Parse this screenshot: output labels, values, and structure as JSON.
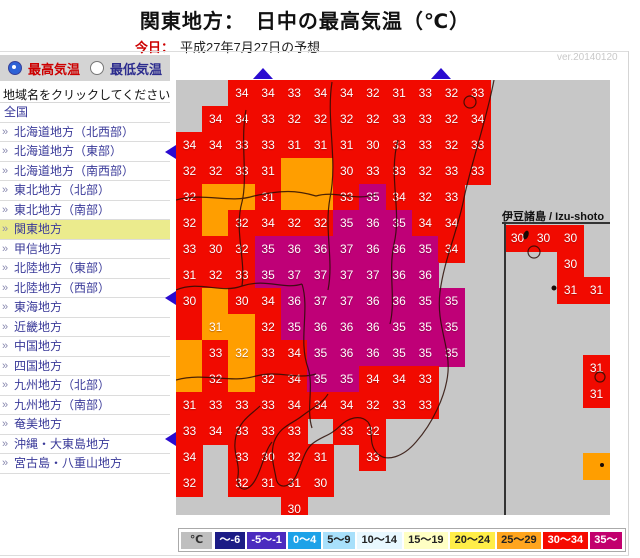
{
  "header": {
    "title": "関東地方：　日中の最高気温（℃）",
    "today_label": "今日：",
    "date_text": "平成27年7月27日の予想",
    "version": "ver.20140120"
  },
  "sidebar": {
    "radio_max": "最高気温",
    "radio_min": "最低気温",
    "instruction": "地域名をクリックしてください",
    "items": [
      {
        "label": "全国",
        "arrow": false,
        "active": false
      },
      {
        "label": "北海道地方（北西部）",
        "arrow": true,
        "active": false
      },
      {
        "label": "北海道地方（東部）",
        "arrow": true,
        "active": false
      },
      {
        "label": "北海道地方（南西部）",
        "arrow": true,
        "active": false
      },
      {
        "label": "東北地方（北部）",
        "arrow": true,
        "active": false
      },
      {
        "label": "東北地方（南部）",
        "arrow": true,
        "active": false
      },
      {
        "label": "関東地方",
        "arrow": true,
        "active": true
      },
      {
        "label": "甲信地方",
        "arrow": true,
        "active": false
      },
      {
        "label": "北陸地方（東部）",
        "arrow": true,
        "active": false
      },
      {
        "label": "北陸地方（西部）",
        "arrow": true,
        "active": false
      },
      {
        "label": "東海地方",
        "arrow": true,
        "active": false
      },
      {
        "label": "近畿地方",
        "arrow": true,
        "active": false
      },
      {
        "label": "中国地方",
        "arrow": true,
        "active": false
      },
      {
        "label": "四国地方",
        "arrow": true,
        "active": false
      },
      {
        "label": "九州地方（北部）",
        "arrow": true,
        "active": false
      },
      {
        "label": "九州地方（南部）",
        "arrow": true,
        "active": false
      },
      {
        "label": "奄美地方",
        "arrow": true,
        "active": false
      },
      {
        "label": "沖縄・大東島地方",
        "arrow": true,
        "active": false
      },
      {
        "label": "宮古島・八重山地方",
        "arrow": true,
        "active": false
      }
    ]
  },
  "map": {
    "izu_label": "伊豆諸島 / Izu-shoto",
    "rows": [
      {
        "r": 0,
        "cells": [
          [
            2,
            "34",
            "R"
          ],
          [
            3,
            "34",
            "R"
          ],
          [
            4,
            "33",
            "R"
          ],
          [
            5,
            "34",
            "R"
          ],
          [
            6,
            "34",
            "R"
          ],
          [
            7,
            "32",
            "R"
          ],
          [
            8,
            "31",
            "R"
          ],
          [
            9,
            "33",
            "R"
          ],
          [
            10,
            "32",
            "R"
          ],
          [
            11,
            "33",
            "R"
          ]
        ]
      },
      {
        "r": 1,
        "cells": [
          [
            1,
            "34",
            "R"
          ],
          [
            2,
            "34",
            "R"
          ],
          [
            3,
            "33",
            "R"
          ],
          [
            4,
            "32",
            "R"
          ],
          [
            5,
            "32",
            "R"
          ],
          [
            6,
            "32",
            "R"
          ],
          [
            7,
            "32",
            "R"
          ],
          [
            8,
            "33",
            "R"
          ],
          [
            9,
            "33",
            "R"
          ],
          [
            10,
            "32",
            "R"
          ],
          [
            11,
            "34",
            "R"
          ]
        ]
      },
      {
        "r": 2,
        "cells": [
          [
            0,
            "34",
            "R"
          ],
          [
            1,
            "34",
            "R"
          ],
          [
            2,
            "33",
            "R"
          ],
          [
            3,
            "33",
            "R"
          ],
          [
            4,
            "31",
            "R"
          ],
          [
            5,
            "31",
            "R"
          ],
          [
            6,
            "31",
            "R"
          ],
          [
            7,
            "30",
            "R"
          ],
          [
            8,
            "33",
            "R"
          ],
          [
            9,
            "33",
            "R"
          ],
          [
            10,
            "32",
            "R"
          ],
          [
            11,
            "33",
            "R"
          ]
        ]
      },
      {
        "r": 3,
        "cells": [
          [
            0,
            "32",
            "R"
          ],
          [
            1,
            "32",
            "R"
          ],
          [
            2,
            "33",
            "R"
          ],
          [
            3,
            "31",
            "R"
          ],
          [
            4,
            "",
            "O"
          ],
          [
            5,
            "",
            "O"
          ],
          [
            6,
            "30",
            "R"
          ],
          [
            7,
            "33",
            "R"
          ],
          [
            8,
            "33",
            "R"
          ],
          [
            9,
            "32",
            "R"
          ],
          [
            10,
            "33",
            "R"
          ],
          [
            11,
            "33",
            "R"
          ]
        ]
      },
      {
        "r": 4,
        "cells": [
          [
            0,
            "32",
            "R"
          ],
          [
            1,
            "",
            "O"
          ],
          [
            2,
            "",
            "O"
          ],
          [
            3,
            "31",
            "R"
          ],
          [
            4,
            "",
            "O"
          ],
          [
            5,
            "",
            "O"
          ],
          [
            6,
            "33",
            "R"
          ],
          [
            7,
            "35",
            "P"
          ],
          [
            8,
            "34",
            "R"
          ],
          [
            9,
            "32",
            "R"
          ],
          [
            10,
            "33",
            "R"
          ]
        ]
      },
      {
        "r": 5,
        "cells": [
          [
            0,
            "32",
            "R"
          ],
          [
            1,
            "",
            "O"
          ],
          [
            2,
            "32",
            "R"
          ],
          [
            3,
            "34",
            "R"
          ],
          [
            4,
            "32",
            "R"
          ],
          [
            5,
            "32",
            "R"
          ],
          [
            6,
            "35",
            "P"
          ],
          [
            7,
            "36",
            "P"
          ],
          [
            8,
            "35",
            "P"
          ],
          [
            9,
            "34",
            "R"
          ],
          [
            10,
            "34",
            "R"
          ]
        ]
      },
      {
        "r": 6,
        "cells": [
          [
            0,
            "33",
            "R"
          ],
          [
            1,
            "30",
            "R"
          ],
          [
            2,
            "32",
            "R"
          ],
          [
            3,
            "35",
            "P"
          ],
          [
            4,
            "36",
            "P"
          ],
          [
            5,
            "36",
            "P"
          ],
          [
            6,
            "37",
            "P"
          ],
          [
            7,
            "36",
            "P"
          ],
          [
            8,
            "36",
            "P"
          ],
          [
            9,
            "35",
            "P"
          ],
          [
            10,
            "34",
            "R"
          ]
        ]
      },
      {
        "r": 7,
        "cells": [
          [
            0,
            "31",
            "R"
          ],
          [
            1,
            "32",
            "R"
          ],
          [
            2,
            "33",
            "R"
          ],
          [
            3,
            "35",
            "P"
          ],
          [
            4,
            "37",
            "P"
          ],
          [
            5,
            "37",
            "P"
          ],
          [
            6,
            "37",
            "P"
          ],
          [
            7,
            "37",
            "P"
          ],
          [
            8,
            "36",
            "P"
          ],
          [
            9,
            "36",
            "P"
          ]
        ]
      },
      {
        "r": 8,
        "cells": [
          [
            0,
            "30",
            "R"
          ],
          [
            1,
            "",
            "O"
          ],
          [
            2,
            "30",
            "R"
          ],
          [
            3,
            "34",
            "R"
          ],
          [
            4,
            "36",
            "P"
          ],
          [
            5,
            "37",
            "P"
          ],
          [
            6,
            "37",
            "P"
          ],
          [
            7,
            "36",
            "P"
          ],
          [
            8,
            "36",
            "P"
          ],
          [
            9,
            "35",
            "P"
          ],
          [
            10,
            "35",
            "P"
          ]
        ]
      },
      {
        "r": 9,
        "cells": [
          [
            0,
            "",
            "R"
          ],
          [
            1,
            "31",
            "O"
          ],
          [
            2,
            "",
            "O"
          ],
          [
            3,
            "32",
            "R"
          ],
          [
            4,
            "35",
            "P"
          ],
          [
            5,
            "36",
            "P"
          ],
          [
            6,
            "36",
            "P"
          ],
          [
            7,
            "36",
            "P"
          ],
          [
            8,
            "35",
            "P"
          ],
          [
            9,
            "35",
            "P"
          ],
          [
            10,
            "35",
            "P"
          ]
        ]
      },
      {
        "r": 10,
        "cells": [
          [
            0,
            "",
            "O"
          ],
          [
            1,
            "33",
            "R"
          ],
          [
            2,
            "32",
            "O"
          ],
          [
            3,
            "33",
            "R"
          ],
          [
            4,
            "34",
            "R"
          ],
          [
            5,
            "35",
            "P"
          ],
          [
            6,
            "36",
            "P"
          ],
          [
            7,
            "36",
            "P"
          ],
          [
            8,
            "35",
            "P"
          ],
          [
            9,
            "35",
            "P"
          ],
          [
            10,
            "35",
            "P"
          ]
        ]
      },
      {
        "r": 11,
        "cells": [
          [
            0,
            "",
            "O"
          ],
          [
            1,
            "32",
            "R"
          ],
          [
            2,
            "",
            "O"
          ],
          [
            3,
            "32",
            "R"
          ],
          [
            4,
            "34",
            "R"
          ],
          [
            5,
            "35",
            "P"
          ],
          [
            6,
            "35",
            "P"
          ],
          [
            7,
            "34",
            "R"
          ],
          [
            8,
            "34",
            "R"
          ],
          [
            9,
            "33",
            "R"
          ]
        ]
      },
      {
        "r": 12,
        "cells": [
          [
            0,
            "31",
            "R"
          ],
          [
            1,
            "33",
            "R"
          ],
          [
            2,
            "33",
            "R"
          ],
          [
            3,
            "33",
            "R"
          ],
          [
            4,
            "34",
            "R"
          ],
          [
            5,
            "34",
            "R"
          ],
          [
            6,
            "34",
            "R"
          ],
          [
            7,
            "32",
            "R"
          ],
          [
            8,
            "33",
            "R"
          ],
          [
            9,
            "33",
            "R"
          ]
        ]
      },
      {
        "r": 13,
        "cells": [
          [
            0,
            "33",
            "R"
          ],
          [
            1,
            "34",
            "R"
          ],
          [
            2,
            "33",
            "R"
          ],
          [
            3,
            "33",
            "R"
          ],
          [
            4,
            "33",
            "R"
          ],
          [
            6,
            "33",
            "R"
          ],
          [
            7,
            "32",
            "R"
          ]
        ]
      },
      {
        "r": 14,
        "cells": [
          [
            0,
            "34",
            "R"
          ],
          [
            2,
            "33",
            "R"
          ],
          [
            3,
            "30",
            "R"
          ],
          [
            4,
            "32",
            "R"
          ],
          [
            5,
            "31",
            "R"
          ],
          [
            7,
            "33",
            "R"
          ]
        ]
      },
      {
        "r": 15,
        "cells": [
          [
            0,
            "32",
            "R"
          ],
          [
            2,
            "32",
            "R"
          ],
          [
            3,
            "31",
            "R"
          ],
          [
            4,
            "31",
            "R"
          ],
          [
            5,
            "30",
            "R"
          ]
        ]
      },
      {
        "r": 16,
        "cells": [
          [
            4,
            "30",
            "R"
          ]
        ]
      }
    ],
    "izu_cells": [
      {
        "x": 328,
        "y": 145,
        "v": "30",
        "t": "R"
      },
      {
        "x": 354,
        "y": 145,
        "v": "30",
        "t": "R"
      },
      {
        "x": 381,
        "y": 145,
        "v": "30",
        "t": "R"
      },
      {
        "x": 381,
        "y": 171,
        "v": "30",
        "t": "R"
      },
      {
        "x": 381,
        "y": 197,
        "v": "31",
        "t": "R"
      },
      {
        "x": 407,
        "y": 197,
        "v": "31",
        "t": "R"
      },
      {
        "x": 407,
        "y": 275,
        "v": "31",
        "t": "R"
      },
      {
        "x": 407,
        "y": 301,
        "v": "31",
        "t": "R"
      },
      {
        "x": 407,
        "y": 373,
        "v": "",
        "t": "O"
      }
    ]
  },
  "legend": {
    "unit": "℃",
    "ranges": [
      {
        "label": "～-6",
        "bg": "#1c1c86",
        "fg": "#ffffff"
      },
      {
        "label": "-5～-1",
        "bg": "#4b2bbf",
        "fg": "#ffffff"
      },
      {
        "label": "0～4",
        "bg": "#1da2e8",
        "fg": "#ffffff"
      },
      {
        "label": "5～9",
        "bg": "#a8e0fb",
        "fg": "#222222"
      },
      {
        "label": "10～14",
        "bg": "#e8f8ff",
        "fg": "#222222"
      },
      {
        "label": "15～19",
        "bg": "#ffffc4",
        "fg": "#222222"
      },
      {
        "label": "20～24",
        "bg": "#ffee48",
        "fg": "#222222"
      },
      {
        "label": "25～29",
        "bg": "#ffa51e",
        "fg": "#222222"
      },
      {
        "label": "30～34",
        "bg": "#f50a00",
        "fg": "#ffffff"
      },
      {
        "label": "35～",
        "bg": "#c2006e",
        "fg": "#ffffff"
      }
    ]
  },
  "colors": {
    "cell_red": "#f10a00",
    "cell_orange": "#ff9e00",
    "cell_purple": "#bf0077",
    "map_bg": "#c7c7c7",
    "arrow": "#2a0bd0",
    "highlight": "#ebeb8d",
    "link": "#3a3a99",
    "today": "#cc0000"
  }
}
